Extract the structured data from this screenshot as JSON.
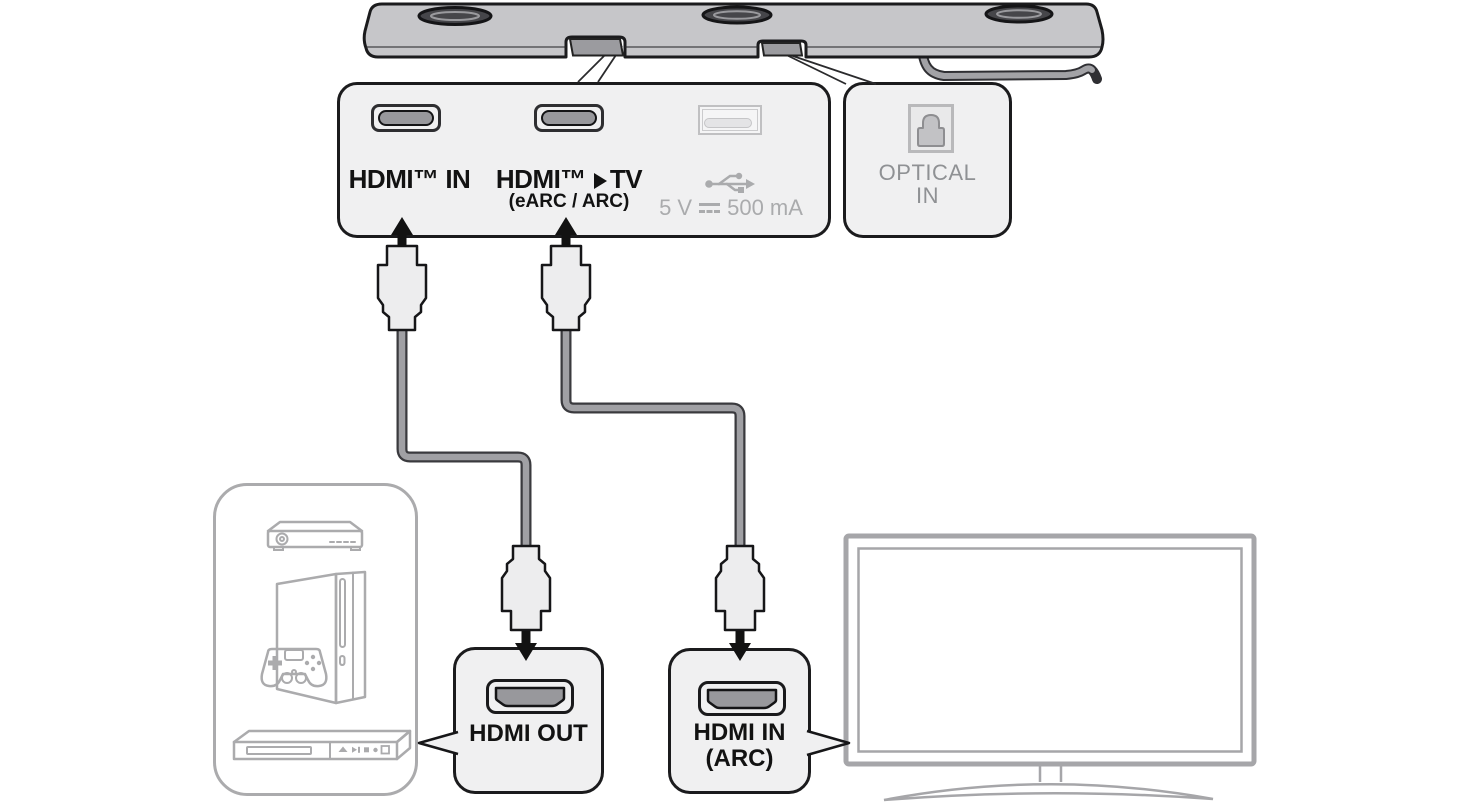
{
  "soundbar_panel": {
    "hdmi_in": {
      "label": "HDMI™ IN"
    },
    "hdmi_tv": {
      "label_prefix": "HDMI™",
      "label_suffix": "TV",
      "sublabel": "(eARC / ARC)"
    },
    "usb": {
      "rating_prefix": "5 V",
      "rating_suffix": "500 mA"
    }
  },
  "optical_panel": {
    "line1": "OPTICAL",
    "line2": "IN"
  },
  "hdmi_out_box": {
    "label": "HDMI OUT"
  },
  "hdmi_in_arc_box": {
    "line1": "HDMI IN",
    "line2": "(ARC)"
  },
  "icons": {
    "hdmi_tv_arrow": "play-triangle",
    "usb_symbol": "usb-trident",
    "dc_symbol": "dc-solid-over-dashed",
    "optical_port": "toslink-port",
    "hdmi_port": "hdmi-connector-profile"
  },
  "colors": {
    "outline-dark": "#1b1b1d",
    "panel-fill": "#f0f0f1",
    "panel-border": "#1b1b1d",
    "port-dark": "#98989c",
    "gray-label": "#8f9194",
    "usb-gray": "#aaabad",
    "usb-port-border": "#c0c0c2",
    "device-outline": "#ababad",
    "tv-outline": "#a6a6a9",
    "cable-gray": "#a0a0a4",
    "cable-edge": "#3a3a3e",
    "soundbar-fill": "#c6c6c9",
    "soundbar-recess": "#9b9b9f",
    "arrow-black": "#121212",
    "connector-fill": "#ededee"
  }
}
